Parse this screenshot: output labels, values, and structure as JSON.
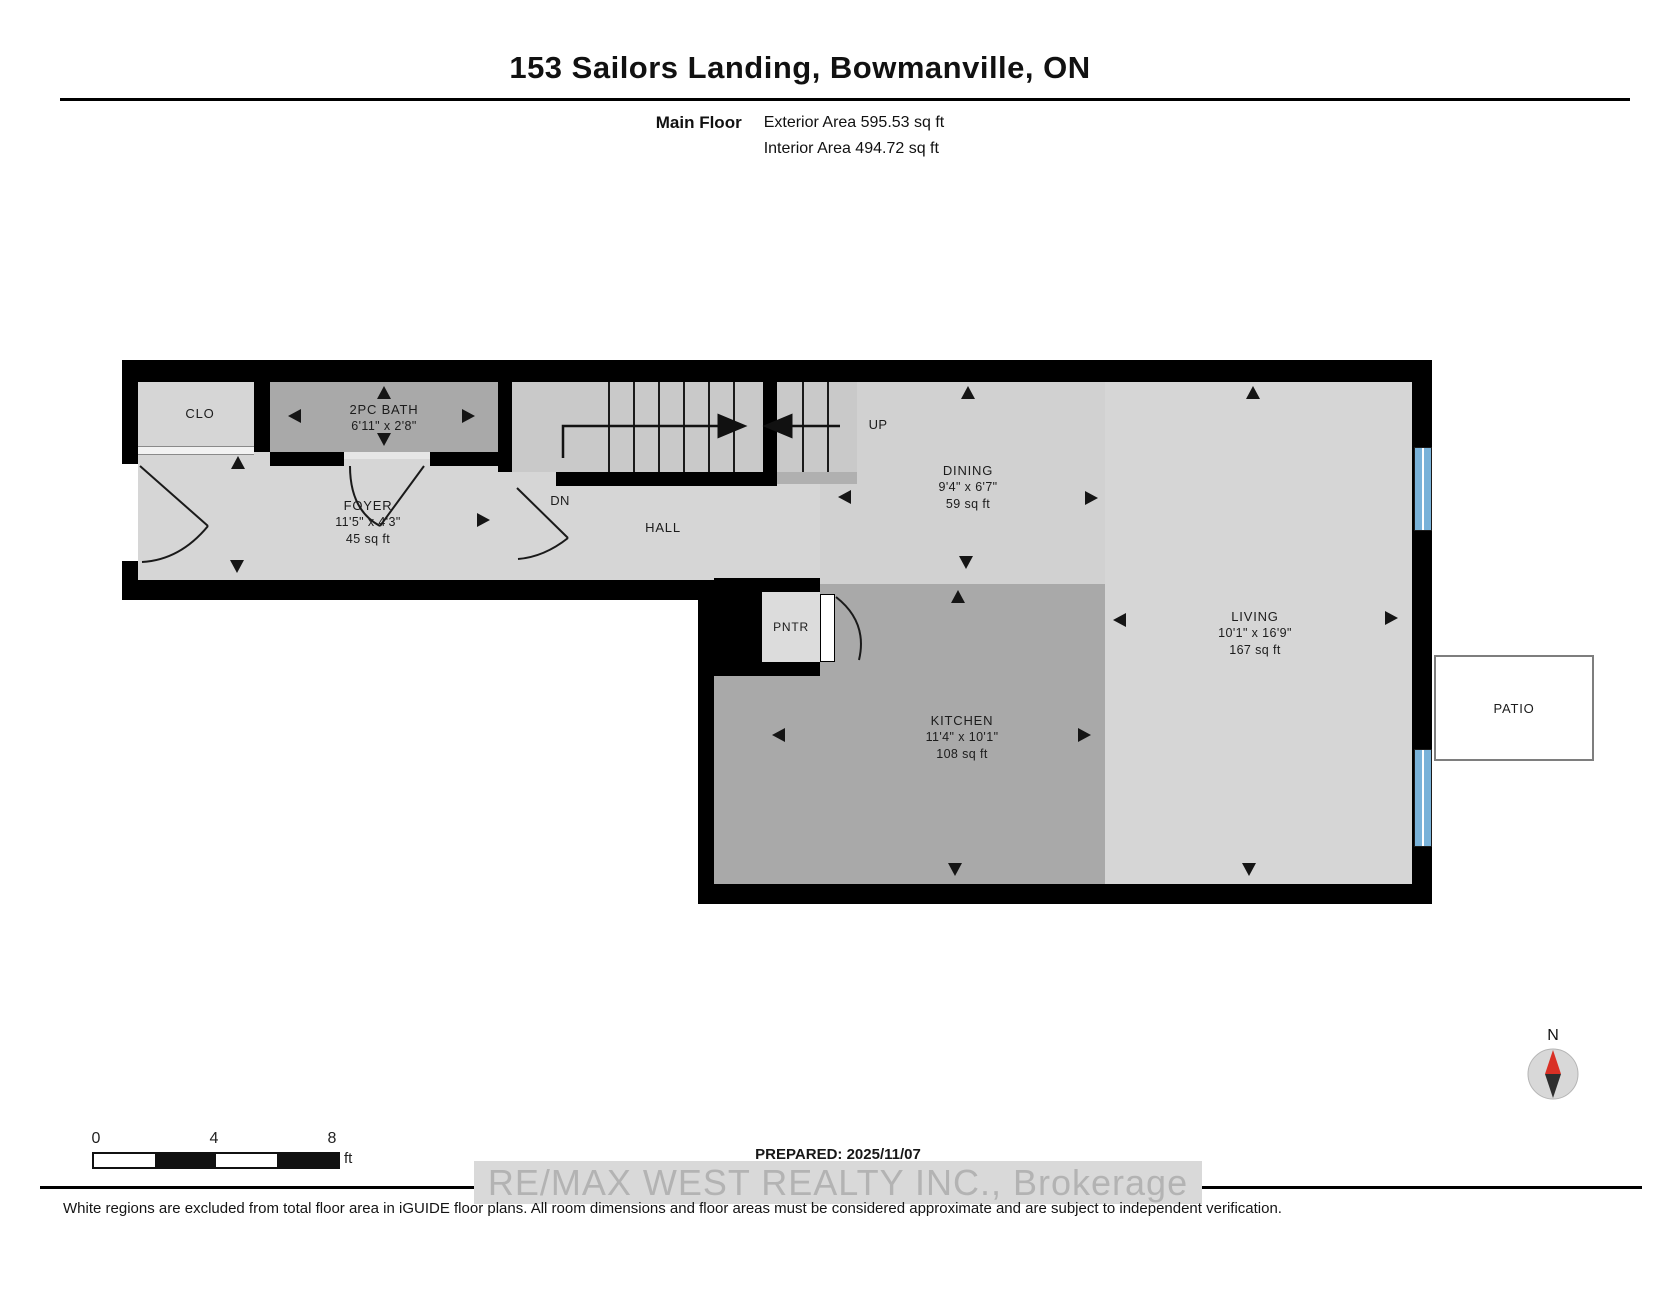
{
  "header": {
    "title": "153 Sailors Landing, Bowmanville, ON",
    "floor_label": "Main Floor",
    "exterior_area": "Exterior Area 595.53 sq ft",
    "interior_area": "Interior Area 494.72 sq ft"
  },
  "rooms": [
    {
      "name": "CLO"
    },
    {
      "name": "2PC BATH",
      "dims": "6'11\" x 2'8\""
    },
    {
      "name": "FOYER",
      "dims": "11'5\" x 4'3\"",
      "area": "45 sq ft"
    },
    {
      "name": "HALL"
    },
    {
      "name": "DINING",
      "dims": "9'4\" x 6'7\"",
      "area": "59 sq ft"
    },
    {
      "name": "KITCHEN",
      "dims": "11'4\" x 10'1\"",
      "area": "108 sq ft"
    },
    {
      "name": "LIVING",
      "dims": "10'1\" x 16'9\"",
      "area": "167 sq ft"
    },
    {
      "name": "PNTR"
    },
    {
      "name": "PATIO"
    }
  ],
  "stairs": {
    "up_label": "UP",
    "down_label": "DN"
  },
  "scale_bar": {
    "tick0": "0",
    "tick4": "4",
    "tick8": "8",
    "unit": "ft"
  },
  "compass": {
    "north_label": "N"
  },
  "footer": {
    "prepared": "PREPARED: 2025/11/07",
    "watermark": "RE/MAX WEST REALTY INC.,  Brokerage",
    "disclaimer": "White regions are excluded from total floor area in iGUIDE floor plans. All room dimensions and floor areas must be considered approximate and are subject to independent verification."
  },
  "colors": {
    "wall": "#000000",
    "room_light": "#d6d6d6",
    "room_medium": "#d1d1d1",
    "room_dark": "#a9a9a9",
    "stair": "#c9c9c9",
    "window_blue": "#79b2d9",
    "compass_red": "#d93025"
  }
}
